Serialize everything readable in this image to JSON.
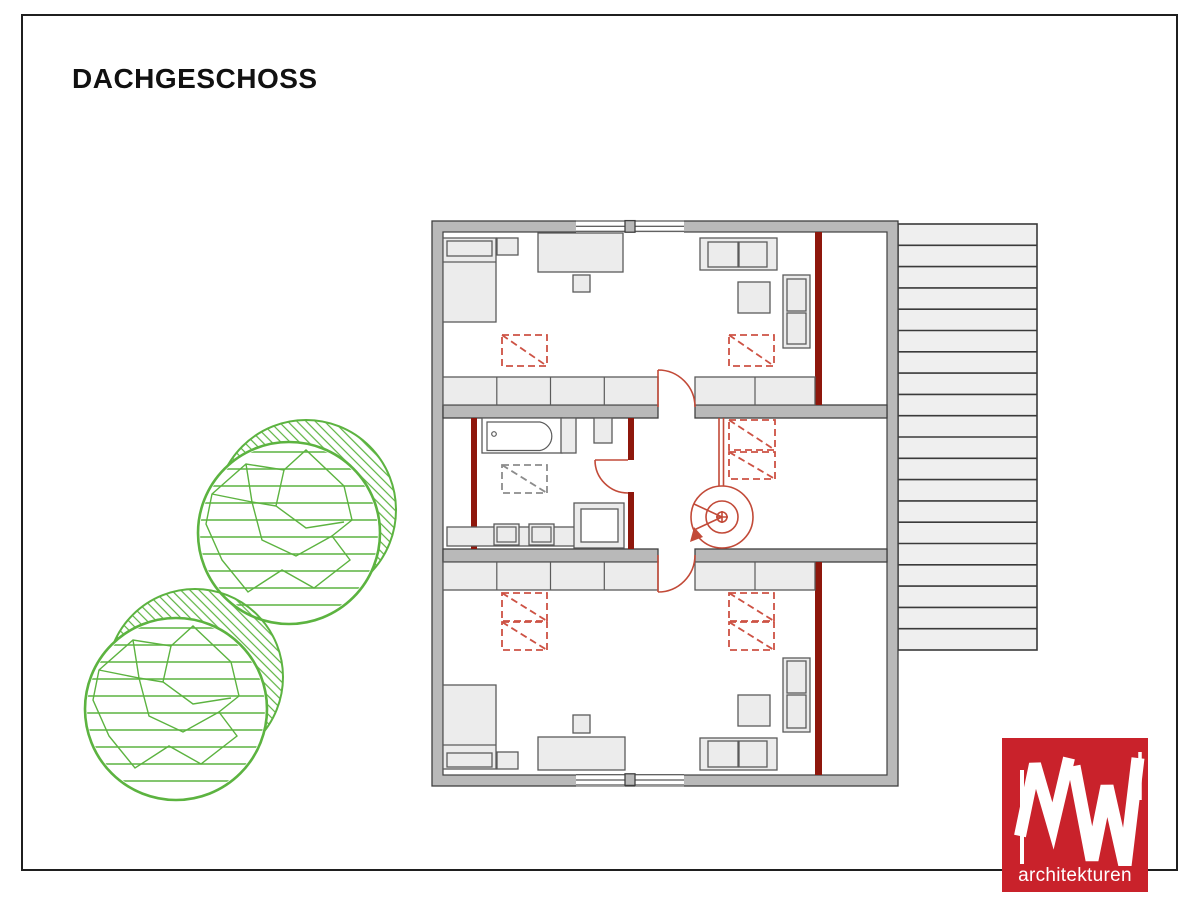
{
  "page": {
    "title": "DACHGESCHOSS"
  },
  "logo": {
    "monogram": "MW",
    "subtitle": "architekturen"
  },
  "colors": {
    "frame": "#1f1f1f",
    "wall_fill": "#b9b9b9",
    "wall_stroke": "#3f3f3f",
    "furniture_fill": "#ececec",
    "furniture_stroke": "#5b5b5b",
    "knee_wall_red": "#8e170c",
    "door_red": "#c24a38",
    "skylight_red": "#cd5244",
    "skylight_gray": "#8c8c8c",
    "terrace_fill": "#efefef",
    "terrace_stroke": "#3a3a3a",
    "tree_green": "#5cb340",
    "logo_red": "#c9222b",
    "title_color": "#111111"
  },
  "floor_plan": {
    "red_skylights": 8,
    "gray_skylights": 1,
    "windows": 4,
    "door_swings": 3,
    "spiral_stairs": 1,
    "trees": 2,
    "roof_slats": 20
  }
}
